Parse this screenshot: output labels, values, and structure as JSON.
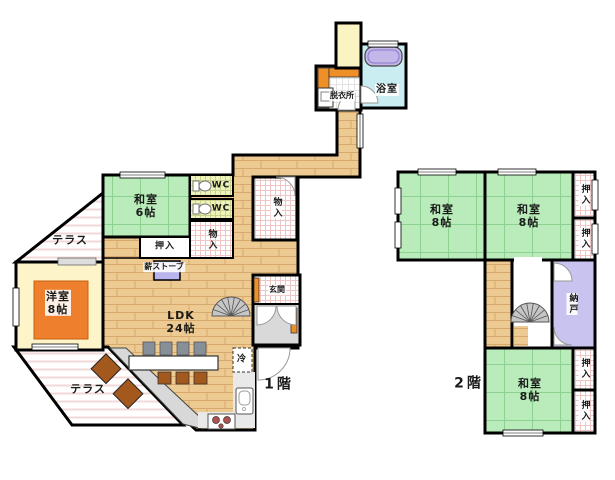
{
  "floor1": {
    "floor_label": "1階",
    "washitsu6": "和室\n6帖",
    "oshiire": "押入",
    "monoire_center": "物入",
    "monoire_right": "物入",
    "wc_top": "WC",
    "wc_bottom": "WC",
    "terrace_upper": "テラス",
    "terrace_lower": "テラス",
    "yoshitsu8": "洋室\n8帖",
    "ldk": "LDK\n24帖",
    "wood_stove": "薪ストーブ",
    "genkan": "玄関",
    "fridge": "冷",
    "datsuijo": "脱衣所",
    "bath": "浴室"
  },
  "floor2": {
    "floor_label": "2階",
    "washitsu8_left": "和室\n8帖",
    "washitsu8_right": "和室\n8帖",
    "washitsu8_bottom": "和室\n8帖",
    "oshiire_top": "押入",
    "oshiire_middle": "押入",
    "oshiire_bottom1": "押入",
    "oshiire_bottom2": "押入",
    "nando": "納戸"
  },
  "colors": {
    "wall": "#000000",
    "tatami": "#b9ecba",
    "wood_floor": "#edca92",
    "western_room": "#fdf5c9",
    "rug": "#ee7f2d",
    "bath": "#c9edf1",
    "bathtub": "#c3b6e9",
    "nando": "#c9c4ef",
    "stove": "#b9b4ec",
    "doma_gray": "#d9d9d9",
    "cabinet_orange": "#ef8f28"
  }
}
